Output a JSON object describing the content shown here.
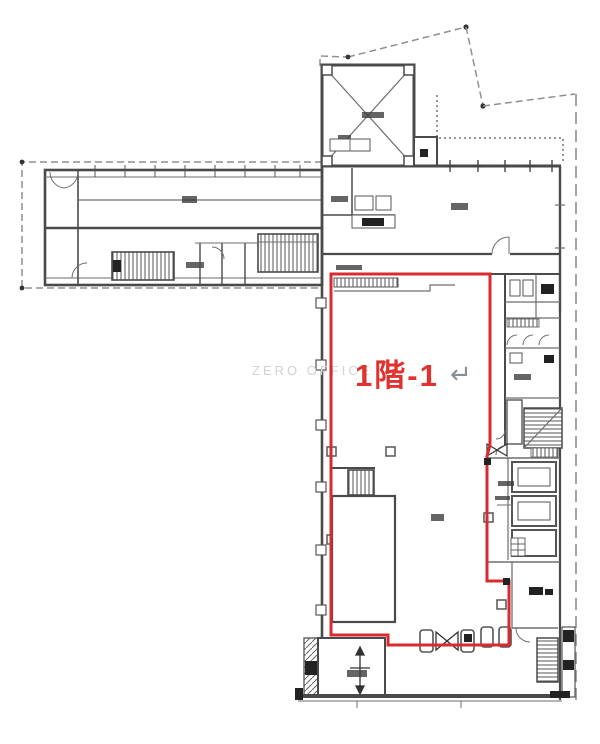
{
  "plan": {
    "unit_label": {
      "text": "1階-1",
      "return_symbol": "↵",
      "color": "#e0322f",
      "symbol_color": "#8a8f94"
    },
    "watermark": {
      "text": "ZERO OFFICE",
      "color": "#cfd4d1"
    },
    "colors": {
      "outline_red": "#d92b2f",
      "wall_dark": "#4a4a4a",
      "boundary_gray": "#8f8f8f",
      "background": "#ffffff"
    }
  }
}
